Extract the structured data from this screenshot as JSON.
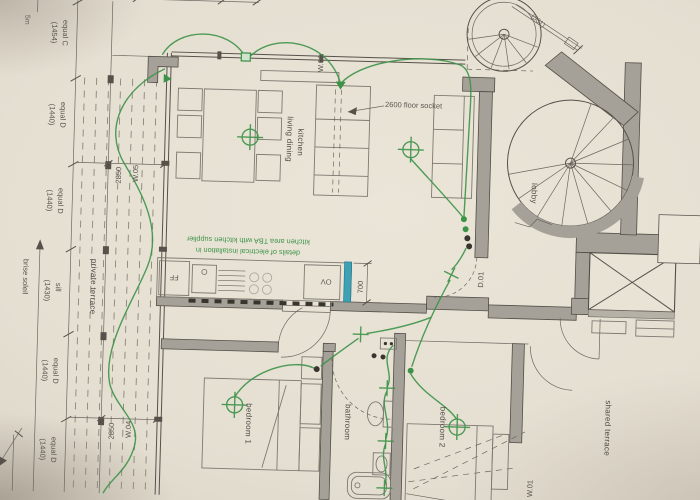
{
  "plan": {
    "rooms": {
      "living_line1": "living dining",
      "living_line2": "kitchen",
      "lobby": "lobby",
      "bedroom1": "bedroom 1",
      "bedroom2": "bedroom 2",
      "bathroom": "bathroom",
      "private_terrace": "private terrace",
      "shared_terrace": "shared terrace"
    },
    "annotations": {
      "floor_socket": "2600 floor socket",
      "kitchen_note_line1": "details of electrical installation in",
      "kitchen_note_line2": "kitchen area TBA with kitchen supplier",
      "brise_soleil": "brise soleil",
      "scale_marker": "5m",
      "stair_ref": "(501)"
    },
    "appliances": {
      "fridge_freezer": "FF",
      "oven": "OV"
    },
    "openings": {
      "door_d01": "D.01",
      "window_w01": "W.01",
      "window_w04": "W.04",
      "window_w05": "W.05",
      "window_w06": "W.06"
    },
    "dimensions": {
      "left_chain": [
        {
          "name": "equal C",
          "value": "(1454)"
        },
        {
          "name": "equal D",
          "value": "(1440)"
        },
        {
          "name": "equal D",
          "value": "(1440)"
        },
        {
          "name": "sill",
          "value": "(1430)"
        },
        {
          "name": "equal D",
          "value": "(1440)"
        },
        {
          "name": "equal D",
          "value": "(1440)"
        }
      ],
      "w05_width": "2850",
      "w04_width": "2850",
      "oven_width": "700"
    },
    "colors": {
      "electrical_green": "#3c9247",
      "counter_teal": "#3da2b5",
      "wall_fill": "#a5a198",
      "paper": "#e7e1d4",
      "line_dark": "#55514a"
    }
  }
}
